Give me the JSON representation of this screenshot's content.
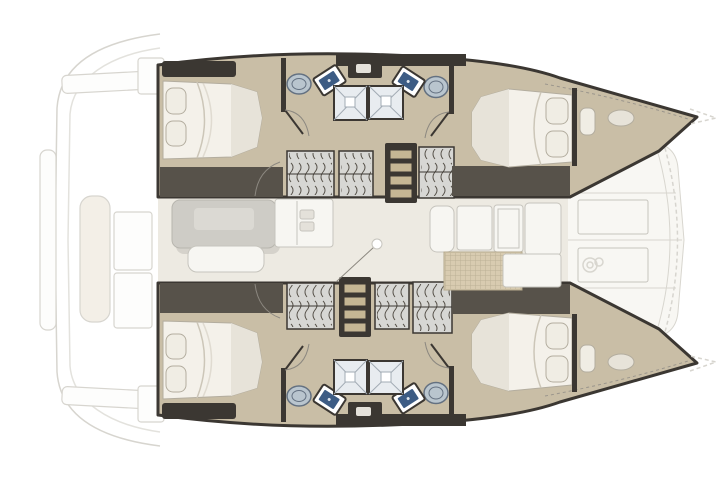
{
  "figure": {
    "type": "boat-floor-plan",
    "subject": "Catamaran interior layout, top-down deck plan",
    "orientation": {
      "bow": "right",
      "stern": "left",
      "port_hull": "top",
      "starboard_hull": "bottom"
    }
  },
  "rooms": {
    "saloon": "Saloon with dinette table, bench seat and galley unit",
    "galley": "Galley counters with floor grate",
    "foredeck": "Forward deck with panels and windlass",
    "cockpit_aft": "Aft cockpit (faint exterior linework)",
    "aft_cabin_port": "Port aft double cabin",
    "fwd_cabin_port": "Port forward double cabin",
    "bow_berth_port": "Port bow berth compartment",
    "bathroom_aft_port": "Port aft bathroom with shower, sink and toilet",
    "bathroom_fwd_port": "Port forward bathroom with shower, sink and toilet",
    "steps_port": "Companionway steps down to port hull",
    "aft_cabin_stbd": "Starboard aft double cabin",
    "fwd_cabin_stbd": "Starboard forward double cabin",
    "bow_berth_stbd": "Starboard bow berth compartment",
    "bathroom_aft_stbd": "Starboard aft bathroom with shower, sink and toilet",
    "bathroom_fwd_stbd": "Starboard forward bathroom with shower, sink and toilet",
    "steps_stbd": "Companionway steps down to starboard hull"
  },
  "inventory": {
    "double_beds": 4,
    "bow_berths": 2,
    "bathrooms": 4,
    "showers": 4,
    "toilets": 4,
    "sinks": 4,
    "companionway_steps": 2,
    "saloon_tables": 1,
    "bench_seats": 1,
    "galley_counters": 5
  },
  "colors": {
    "wood": "#c9bea6",
    "dark": "#3b3732",
    "dark2": "#57524a",
    "saloon": "#edeae2",
    "mattress": "#f4f1ea",
    "mattressShade": "#e7e3d9",
    "mattressEdge": "#b3ad9f",
    "pillow": "#f0ede4",
    "foldLine": "#ccc6b8",
    "locker": "#d7d7d4",
    "step": "#c5b694",
    "shower": "#e8ecf0",
    "showerLine": "#a2abb4",
    "basin": "#3d5c84",
    "toilet": "#b9c5ce",
    "toiletEdge": "#647181",
    "table": "#ceccc6",
    "tableTop": "#dbd9d3",
    "tableEdge": "#b8b6af",
    "counter": "#f7f6f2",
    "counterEdge": "#c6c4bd",
    "handle": "#e4e1da",
    "mat": "#d8cbb0",
    "matEdge": "#b4a88c",
    "foredeck": "#f8f7f3",
    "foredeckEdge": "#d8d6cf",
    "exteriorLine": "#d7d5cf",
    "exteriorFill": "#fdfdfc",
    "creamBench": "#f3efe7",
    "arcLine": "#8c8880",
    "toerail": "#9a958c"
  }
}
